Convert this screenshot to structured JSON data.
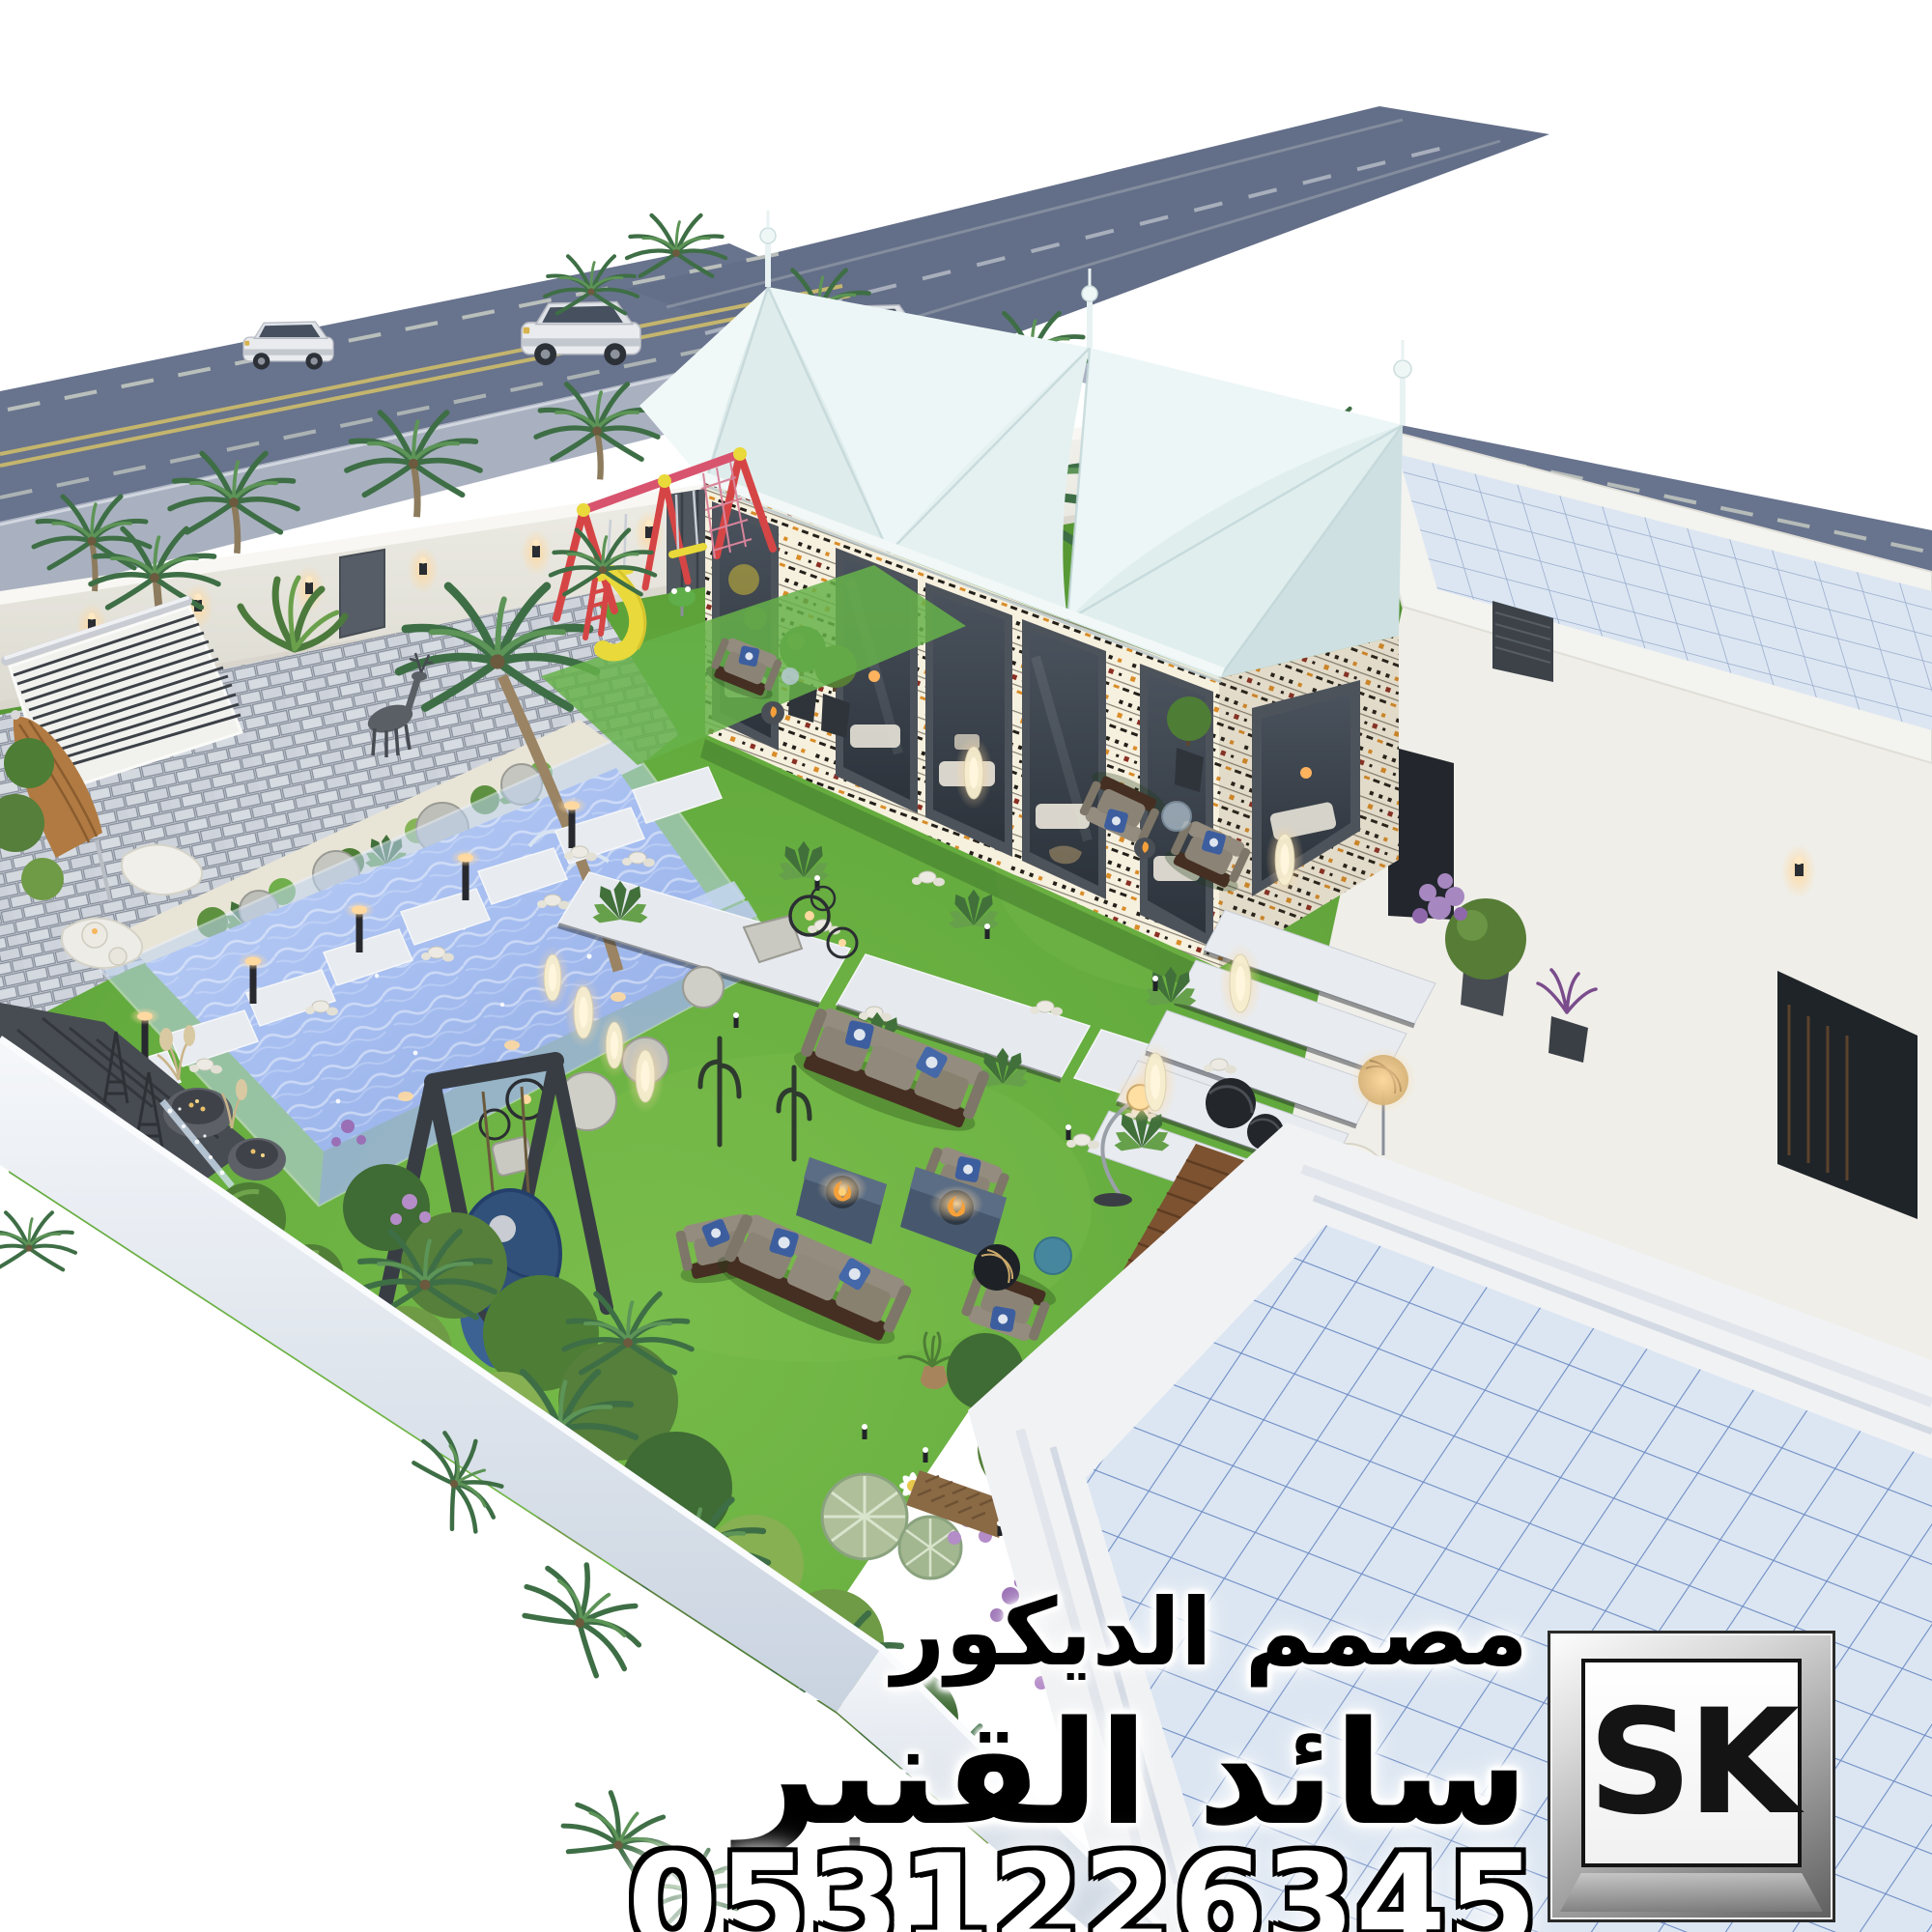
{
  "image_type": "3d-architectural-landscape-render",
  "watermark": {
    "title_line": "مصمم الديكور",
    "name_line": "سائد القنبر",
    "phone": "0531226345",
    "logo_text": "SK"
  },
  "palette": {
    "background": "#ffffff",
    "asphalt": "#68738d",
    "road_marking_yellow": "#c4b56d",
    "road_marking_white": "#c8cdc3",
    "sidewalk": "#a9b1c0",
    "wall_white": "#ecebe5",
    "grass_green": "#61a83d",
    "pool_water": "#a9c0ee",
    "pool_glass": "#bfd4f2",
    "marble_slab": "#e8ebef",
    "patio_paver": "#c9cfd8",
    "tent_canvas": "#e0eeee",
    "sadu_cream": "#f6f0de",
    "sadu_orange": "#d98c28",
    "window_frame": "#4d535b",
    "sofa_gray": "#8d867a",
    "wood_dark": "#452f22",
    "deck_wood": "#7c5231",
    "roof_tile": "#dce6f2",
    "roof_tile_line": "#6e8cc4",
    "playground_red": "#d64545",
    "playground_yellow": "#e9d93a",
    "umbrella_tan": "#b07a42",
    "flower_purple": "#b48cc8",
    "fire_orange": "#f6a03a",
    "lamp_glow": "#ffd9a0"
  },
  "scene": {
    "elements": [
      "main-road",
      "side-street",
      "street-sidewalk",
      "perimeter-wall",
      "wall-lamps",
      "parked-suvs",
      "palm-trees",
      "majlis-tents",
      "sadu-pattern-band",
      "tent-glass-walls",
      "kids-playground",
      "swing-set",
      "slide",
      "swimming-pool",
      "pool-glass-walls",
      "pool-planting-bed",
      "paved-patio",
      "louvered-shade",
      "closed-parasol",
      "white-loungers",
      "deer-sculpture",
      "marble-step-path",
      "marble-stair-treads",
      "lawn",
      "outdoor-sofa-sets",
      "fire-pit-tables",
      "hanging-swing-frame",
      "garden-lanterns",
      "cactus-garden",
      "purple-flower-beds",
      "wood-deck",
      "deck-lounger",
      "villa-white-block",
      "tiled-pavilion-roof",
      "tiled-main-roof",
      "boundary-wall-cut"
    ]
  }
}
